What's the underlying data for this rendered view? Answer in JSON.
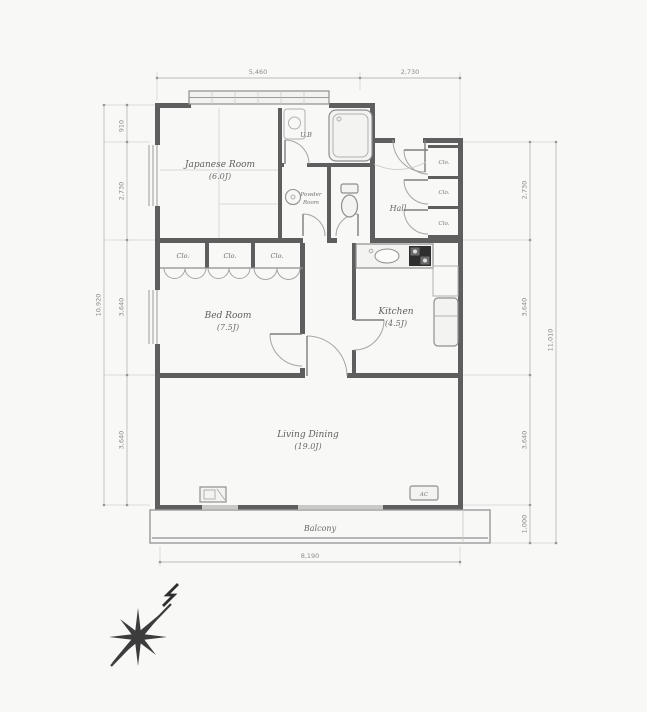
{
  "plan": {
    "rooms": {
      "japanese": {
        "name": "Japanese Room",
        "size": "(6.0J)"
      },
      "bed": {
        "name": "Bed Room",
        "size": "(7.5J)"
      },
      "kitchen": {
        "name": "Kitchen",
        "size": "(4.5J)"
      },
      "living": {
        "name": "Living Dining",
        "size": "(19.0J)"
      },
      "hall": {
        "name": "Hall"
      },
      "powder": {
        "line1": "Powder",
        "line2": "Room"
      },
      "bath": {
        "name": "U.B"
      },
      "balcony": {
        "name": "Balcony"
      }
    },
    "closets": {
      "row": [
        "Clo.",
        "Clo.",
        "Clo."
      ],
      "hall": [
        "Clo.",
        "Clo.",
        "Clo."
      ]
    },
    "fixtures": {
      "ac": "AC"
    },
    "dims": {
      "top": [
        "5,460",
        "2,730"
      ],
      "bottom": "8,190",
      "left_total": "10,920",
      "left": [
        "910",
        "2,730",
        "3,640",
        "3,640"
      ],
      "right_total": "11,010",
      "right": [
        "2,730",
        "3,640",
        "3,640",
        "1,000"
      ]
    }
  },
  "colors": {
    "wall": "#5e5e5e",
    "line": "#8f8f8f",
    "background": "#f8f8f7"
  }
}
